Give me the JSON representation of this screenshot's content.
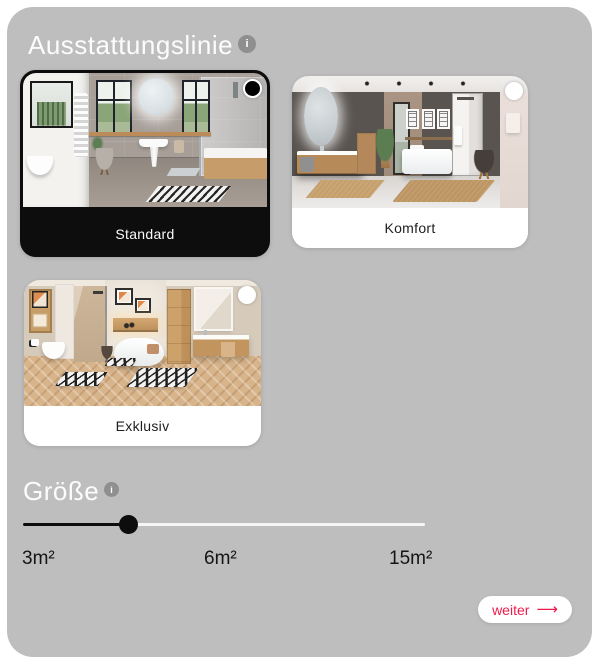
{
  "theme": {
    "page_bg": "#ffffff",
    "panel_bg": "#bebebe",
    "accent": "#ec1b4b",
    "selection_black": "#0d0d0d"
  },
  "ausstattungslinie": {
    "title": "Ausstattungslinie",
    "info_icon": "i",
    "cards": [
      {
        "label": "Standard",
        "selected": true,
        "photo": "bathroom-standard"
      },
      {
        "label": "Komfort",
        "selected": false,
        "photo": "bathroom-komfort"
      },
      {
        "label": "Exklusiv",
        "selected": false,
        "photo": "bathroom-exklusiv"
      }
    ]
  },
  "groesse": {
    "title": "Größe",
    "info_icon": "i",
    "slider": {
      "thumb_percent": 26,
      "labels": [
        "3m²",
        "6m²",
        "15m²"
      ]
    }
  },
  "footer": {
    "weiter_label": "weiter",
    "arrow_icon": "⟶"
  }
}
